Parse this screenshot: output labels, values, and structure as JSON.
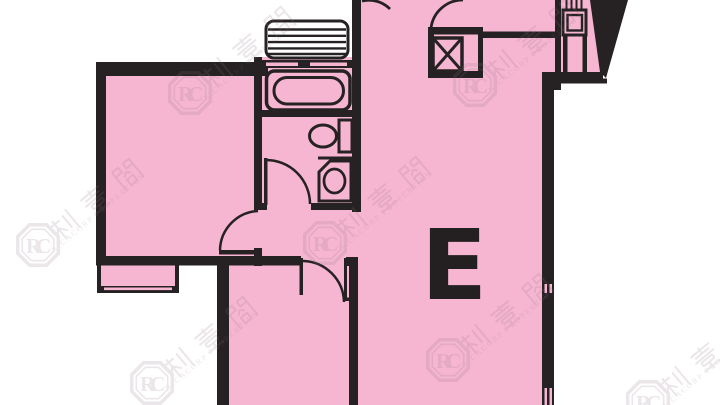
{
  "floor_plan": {
    "unit_label": "E",
    "watermark": {
      "logo_text": "RC",
      "cjk_text": "利嘉閣",
      "latin_text": "RICACORP PROPERTIES"
    },
    "colors": {
      "room_fill": "#f6b6d1",
      "wall": "#262223",
      "background": "#ffffff",
      "watermark": "#8f6e80",
      "louvre_fill": "#ffffff"
    },
    "fixtures": [
      "bathtub",
      "toilet",
      "wash-basin",
      "louvre-window",
      "bay-window",
      "duct-x-box",
      "vent-grille",
      "entrance-door",
      "bedroom-door",
      "bathroom-door",
      "kitchen-door",
      "window-slits"
    ]
  }
}
